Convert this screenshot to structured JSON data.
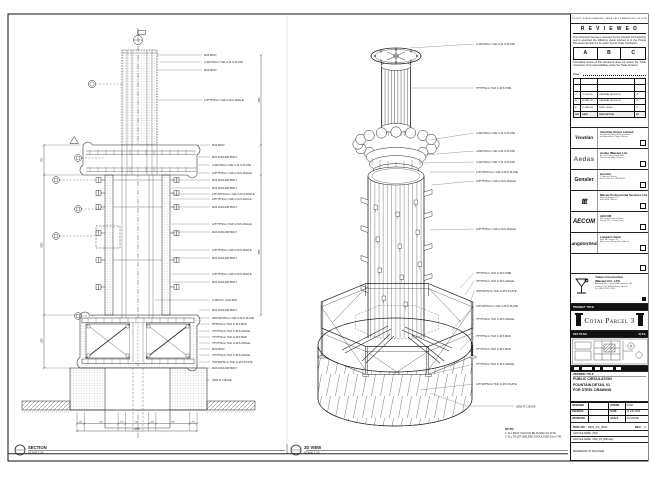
{
  "section": {
    "title": "SECTION",
    "scale": "SCALE 1:25",
    "callouts": [
      "M20 BOLT",
      "4-340*20mm THK G.M.S PLATE",
      "M20 BOLT",
      "125*75*9mm THK G.M.S ANGLE",
      "M20 BOLT",
      "M20 ANCHOR BOLT",
      "4-340*20mm THK G.M.S PLATE",
      "125*75*9mm THK G.M.S ANGLE",
      "M20 ANCHOR BOLT",
      "M20 ANCHOR BOLT",
      "125*125*10mm THK G.M.S ANGLE",
      "125*75*9mm THK G.M.S ANGLE",
      "M20 ANCHOR BOLT",
      "125*75*9mm THK G.M.S ANGLE",
      "M20 ANCHOR BOLT",
      "125*75*9mm THK G.M.S ANGLE",
      "M20 ANCHOR BOLT",
      "125*75*9mm THK G.M.S ANGLE",
      "M20 ANCHOR BOLT",
      "4-350 R.C COLUMN",
      "M20 ANCHOR BOLT",
      "450*200*20mm THK G.M.S PLATE",
      "50*50*6mm THK G.M.S BAR",
      "75*75*6mm THK G.M.S ANGLE",
      "75*75*6mm THK G.M.S BAR",
      "75*75*6mm THK G.M.S ANGLE",
      "M20 BOLT",
      "75*75*6mm THK G.M.S ANGLE",
      "700*200*6mm THK G.M.S PLATE",
      "M20 ANCHOR BOLT",
      "A350 R.C BASE"
    ],
    "dims_bottom": [
      "200",
      "944",
      "200",
      "650",
      "200",
      "944",
      "200"
    ],
    "dim_total": "3338",
    "dims_left": [
      "750",
      "3500",
      "1325"
    ],
    "dims_right": [
      "2250",
      "3875"
    ]
  },
  "view3d": {
    "title": "3D VIEW",
    "scale": "SCALE 1:25",
    "callouts": [
      "4-340*20mm THK G.M.S PLATE",
      "75*75*6mm THK G.M.S PIPE",
      "4-340*20mm THK G.M.S PLATE",
      "4-800*20mm THK G.M.S PLATE",
      "4-340*20mm THK G.M.S PLATE",
      "125*125*10mm THK G.M.S PLATE",
      "125*75*9mm THK G.M.S ANGLE",
      "125*75*9mm THK G.M.S ANGLE",
      "75*75*6mm THK G.M.S PIPE",
      "75*75*6mm THK G.M.S ANGLE",
      "450*200*6mm THK G.M.S PLATE",
      "125*125*10mm THK G.M.S PLATE",
      "75*75*6mm THK G.M.S ANGLE",
      "75*75*6mm THK G.M.S BAR",
      "75*75*6mm THK G.M.S BAR",
      "75*75*6mm THK G.M.S ANGLE",
      "125*125*6mm THK G.M.S PLATE",
      "A350 R.C BASE"
    ]
  },
  "note": {
    "heading": "NOTE:",
    "lines": [
      "1. ALL BOLT SHOULD BE FIXING ON SITE.",
      "2. ALL FILLET WELDED SHOULD BE 6mm THK."
    ]
  },
  "titleblock": {
    "margin_note": "DO NOT SCALE DRAWING. VERIFY ALL DIMENSIONS ON SITE",
    "reviewed": {
      "title": "R E V I E W E D",
      "para1": "This document has been reviewed by the relevant Consultant(s) and is accorded the following status referred to in the Project Procedure Section 5.4 for action by the Trade Contractor.",
      "options": [
        "A",
        "B",
        "C"
      ],
      "para2": "Consultant review of this document does not relieve the Trade Contractor of its responsibilities under the Trade Contract.",
      "date_label": "Date :"
    },
    "revisions": {
      "headers": [
        "REV",
        "DATE",
        "DESCRIPTION",
        "BY"
      ],
      "rows": [
        [
          "C",
          "10 JUN 09",
          "GENERAL REVISION",
          "VL"
        ],
        [
          "B",
          "28 MAY 09",
          "GENERAL REVISION",
          "VL"
        ],
        [
          "A",
          "15 MAY 09",
          "FIRST ISSUE",
          "VL"
        ]
      ]
    },
    "consultants": [
      {
        "logo": "Venetian",
        "name": "Venetian Orient Limited",
        "line1": "Estrada da Baía de N. Senhora",
        "line2": "da Esperança, Taipa, Macau"
      },
      {
        "logo": "Aedas",
        "name": "Aedas (Macau) Ltd.",
        "line1": "Av. da Praia Grande 409",
        "line2": "China Law Bldg, Macau"
      },
      {
        "logo": "Gensler",
        "name": "Gensler",
        "line1": "2 Harrison Street",
        "line2": "San Francisco, CA 94105"
      },
      {
        "logo": "ttt",
        "name": "Macau Professional Services Ltd.",
        "line1": "Rua de Xangai 175",
        "line2": "Edf. ACM, Macau"
      },
      {
        "logo": "AECOM",
        "name": "AECOM",
        "line1": "8/F Grand Central Plaza",
        "line2": "Shatin, N.T., Hong Kong"
      },
      {
        "logo": "LangdonSeah",
        "name": "Langdon Seah",
        "line1": "Rua do Campo 78",
        "line2": "Edf. Com. Zhang Kian, Macau"
      }
    ],
    "contractor": {
      "name1": "Yadee Construction",
      "name2": "(Macau) CO., LTD.",
      "line1": "Alameda Dr. Carlos D'Assumpção 181",
      "line2": "Centro Com. Brilhantismo, Macau",
      "line3": "Tel: (853) 2870 3113"
    },
    "project": {
      "bar": "PROJECT TITLE",
      "name": "Cotai Parcel 3"
    },
    "keyplan": {
      "bar_left": "KEY PLAN",
      "bar_right": "N.T.S."
    },
    "drawing": {
      "label": "DRAWING TITLE:",
      "lines": [
        "PUBLIC CIRCULATION",
        "FOUNTAIN DETAIL 01",
        "FOR STEEL DRAWING"
      ]
    },
    "approval": {
      "rows": [
        {
          "l": "DESIGNED",
          "lv": "-",
          "r": "DRAWN",
          "rv": "CHAN"
        },
        {
          "l": "CHECKED",
          "lv": "-",
          "r": "DATE",
          "rv": "10 JUN 2009"
        },
        {
          "l": "APPROVED",
          "lv": "-",
          "r": "SCALE",
          "rv": "AS SHOWN"
        }
      ],
      "dwg_label": "DWG NO :",
      "dwg_no": "0502_PS_0000",
      "rev_label": "REV :",
      "rev": "C",
      "cad1": "CAD FILE NAME : 0502",
      "cad2": "CAD FILE NAME : 0502_PS_0000.dwg",
      "ref": "REFERENCE ON FILE NAME"
    }
  }
}
